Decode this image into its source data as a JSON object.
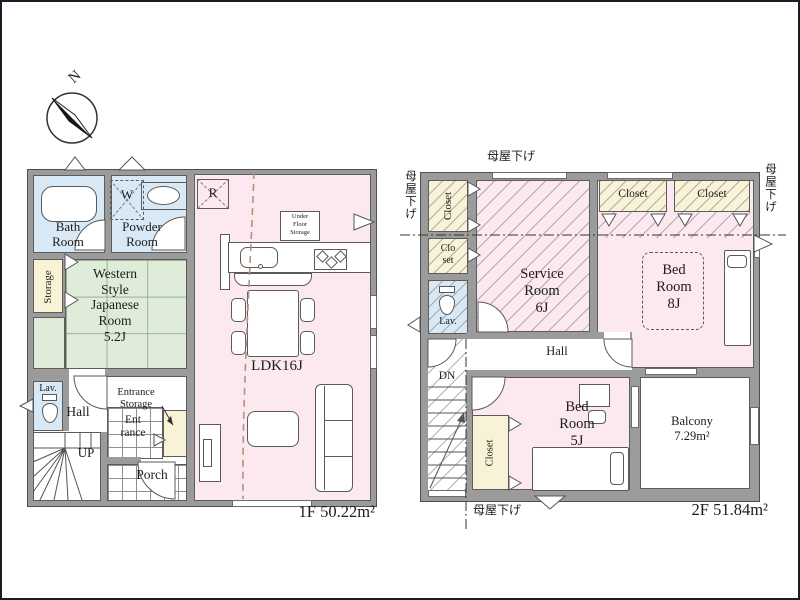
{
  "colors": {
    "wall": "#9b9b9b",
    "outline": "#4e4e4e",
    "water_room": "#d8e9f5",
    "living_room": "#fbe9ef",
    "tatami_room": "#e0ecda",
    "storage_room": "#f8f2d7",
    "roof_line": "#b5917e"
  },
  "compass": {
    "label": "N"
  },
  "floor1": {
    "area": "1F 50.22m²",
    "bath": "Bath\nRoom",
    "powder": "Powder\nRoom",
    "washer": "W",
    "storage": "Storage",
    "western": "Western\nStyle\nJapanese\nRoom\n5.2J",
    "lav": "Lav.",
    "hall": "Hall",
    "up": "UP",
    "entrance_storage": "Entrance\nStorage",
    "entrance": "Ent\nrance",
    "porch": "Porch",
    "ldk": "LDK16J",
    "fridge": "R",
    "under_floor": "Under\nFloor\nStorage"
  },
  "floor2": {
    "area": "2F 51.84m²",
    "moya_top": "母屋下げ",
    "moya_left": "母屋下げ",
    "moya_right": "母屋下げ",
    "moya_bottom": "母屋下げ",
    "closet_top_left": "Closet",
    "closet_small": "Clo\nset",
    "lav": "Lav.",
    "service": "Service\nRoom\n6J",
    "closet_a": "Closet",
    "closet_b": "Closet",
    "bed8": "Bed\nRoom\n8J",
    "hall": "Hall",
    "down": "DN",
    "closet_bottom": "Closet",
    "bed5": "Bed\nRoom\n5J",
    "balcony": "Balcony\n7.29m²"
  }
}
